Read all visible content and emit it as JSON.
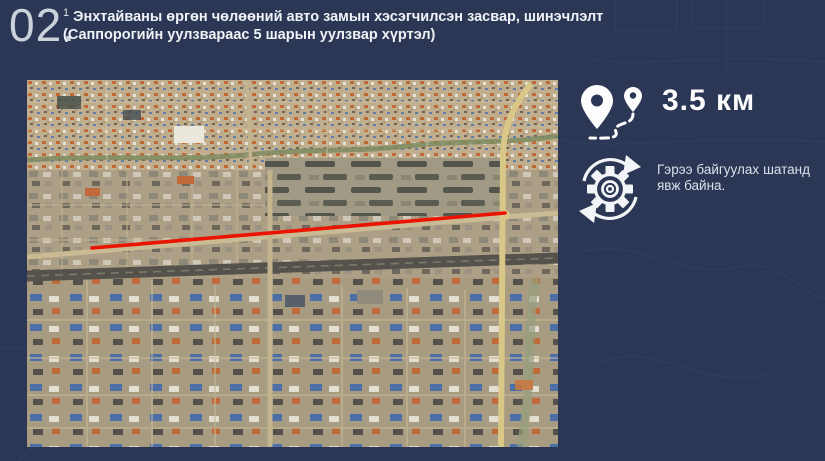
{
  "colors": {
    "background": "#2b3754",
    "route_highlight": "#ea1400",
    "text_primary": "#f0f3f7",
    "text_muted": "#ccd2dc"
  },
  "header": {
    "number": "02.",
    "footnote": "1",
    "title": "Энхтайваны өргөн чөлөөний авто замын хэсэгчилсэн засвар, шинэчлэлт",
    "subtitle": "(Саппорогийн уулзвараас 5 шарын уулзвар хүртэл)"
  },
  "map": {
    "kind": "satellite-map",
    "route_color": "#ea1400"
  },
  "panel": {
    "distance": {
      "icon": "route-distance-icon",
      "value": "3.5 км"
    },
    "status": {
      "icon": "process-gear-icon",
      "text": "Гэрээ байгуулах шатанд явж байна."
    }
  }
}
